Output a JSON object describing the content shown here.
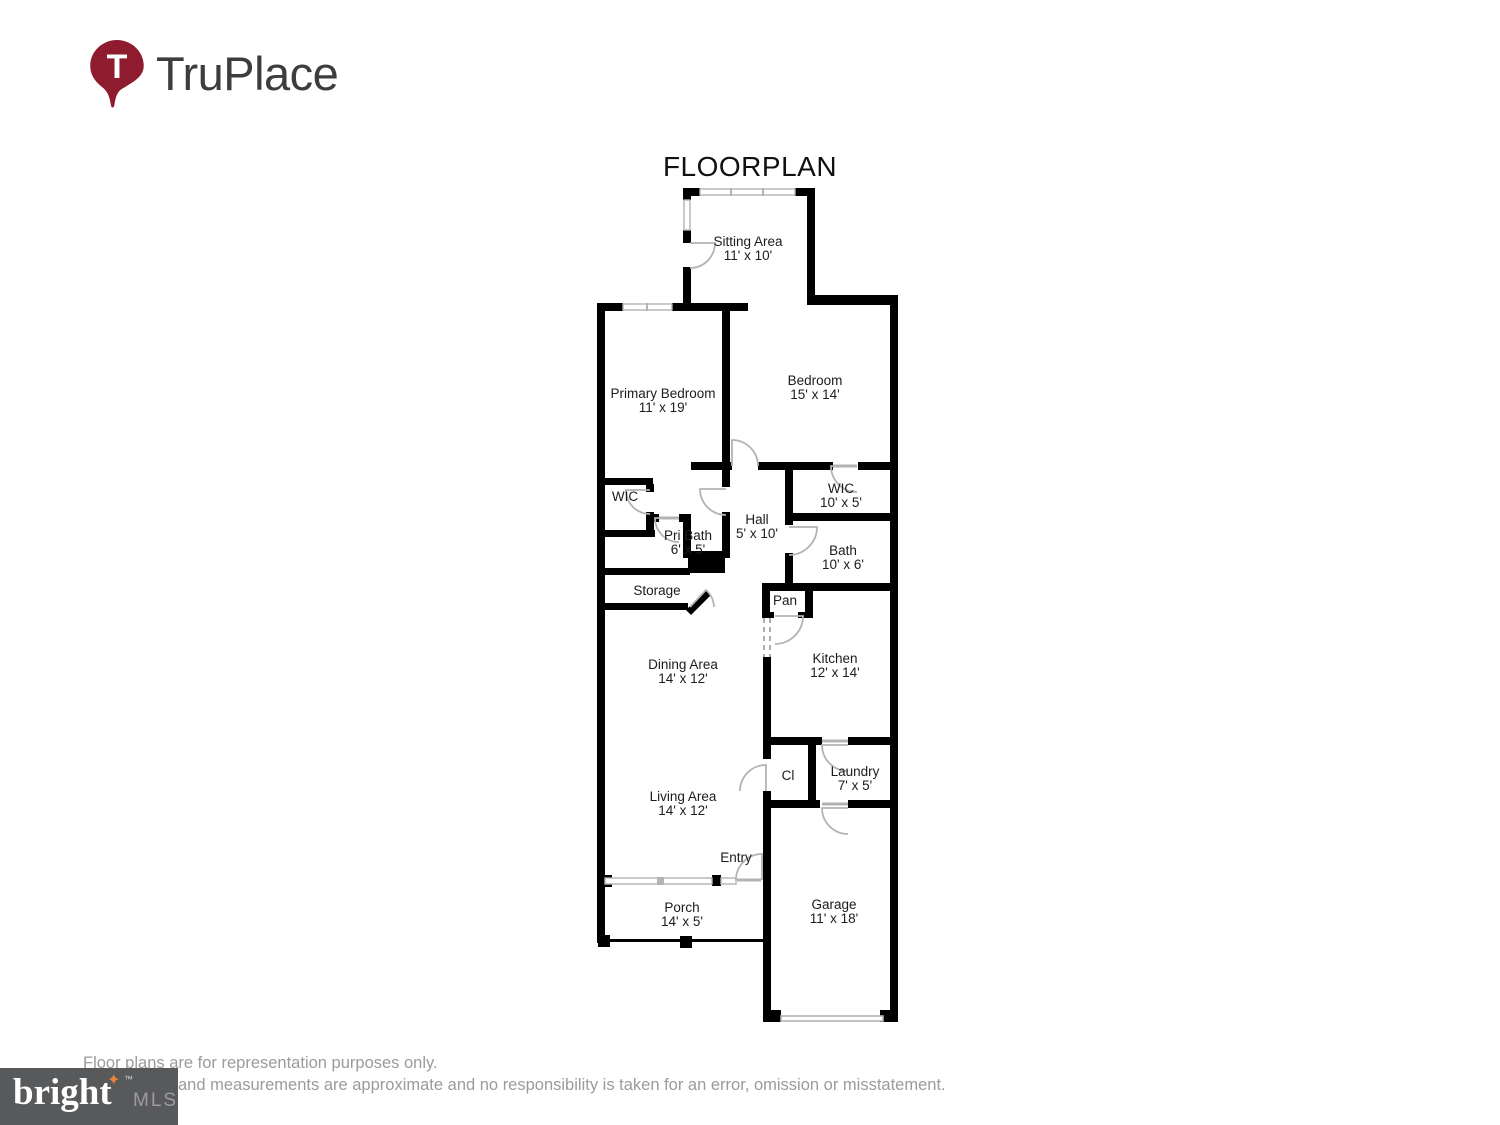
{
  "title": "FLOORPLAN",
  "logo": {
    "brand": "TruPlace",
    "pin_letter": "T",
    "pin_color": "#8e1c2e",
    "text_color": "#3d3d3d"
  },
  "plan_colors": {
    "wall": "#000000",
    "door_window_gray": "#b3b3b3",
    "open_passage_dash": "#999999"
  },
  "rooms": [
    {
      "name": "Sitting Area",
      "dims": "11' x 10'"
    },
    {
      "name": "Primary Bedroom",
      "dims": "11' x 19'"
    },
    {
      "name": "Bedroom",
      "dims": "15' x 14'"
    },
    {
      "name": "WIC",
      "dims": ""
    },
    {
      "name": "Pri Bath",
      "dims": "6' x 5'"
    },
    {
      "name": "Hall",
      "dims": "5' x 10'"
    },
    {
      "name": "WIC",
      "dims": "10' x 5'"
    },
    {
      "name": "Bath",
      "dims": "10' x 6'"
    },
    {
      "name": "Storage",
      "dims": ""
    },
    {
      "name": "Pan",
      "dims": ""
    },
    {
      "name": "Dining Area",
      "dims": "14' x 12'"
    },
    {
      "name": "Kitchen",
      "dims": "12' x 14'"
    },
    {
      "name": "Living Area",
      "dims": "14' x 12'"
    },
    {
      "name": "Cl",
      "dims": ""
    },
    {
      "name": "Laundry",
      "dims": "7' x 5'"
    },
    {
      "name": "Entry",
      "dims": ""
    },
    {
      "name": "Porch",
      "dims": "14' x 5'"
    },
    {
      "name": "Garage",
      "dims": "11' x 18'"
    }
  ],
  "footer": {
    "disclaimer_line1": "Floor plans are for representation purposes only.",
    "disclaimer_line2": "and measurements are approximate and no responsibility is taken for an error, omission or misstatement.",
    "mls": {
      "brand": "bright",
      "suffix": "MLS",
      "tm": "™",
      "star": "✦",
      "bg_color": "#58595b",
      "star_color": "#e8833a"
    }
  }
}
